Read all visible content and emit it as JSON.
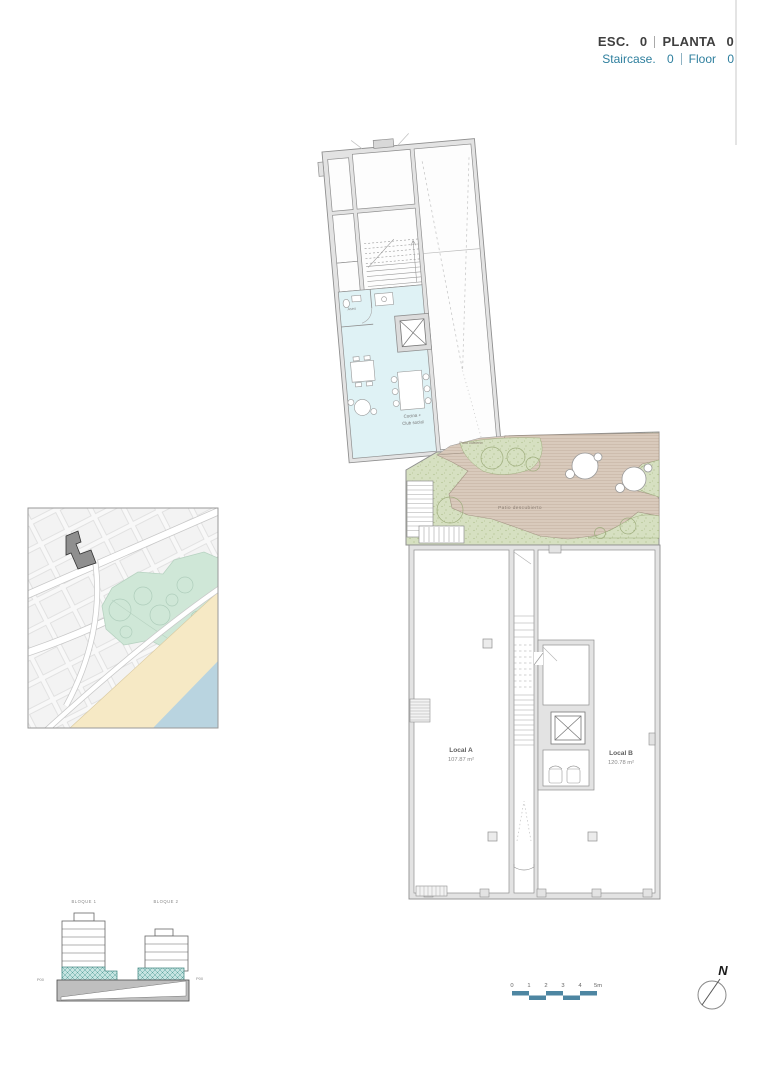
{
  "header": {
    "esc_label": "ESC.",
    "esc_value": "0",
    "planta_label": "PLANTA",
    "planta_value": "0",
    "staircase_label": "Staircase.",
    "staircase_value": "0",
    "floor_label": "Floor",
    "floor_value": "0"
  },
  "plan": {
    "labels": {
      "aseo": "Aseo",
      "cocina_line1": "Cocina +",
      "cocina_line2": "Club social",
      "patio_cubierto": "Patio cubierto",
      "patio_descubierto": "Patio descubierto",
      "local_a_name": "Local A",
      "local_a_area": "107.87 m²",
      "local_b_name": "Local B",
      "local_b_area": "120.78 m²"
    }
  },
  "elevation": {
    "bloque1": "BLOQUE 1",
    "bloque2": "BLOQUE 2",
    "p00_left": "P00",
    "p00_right": "P00"
  },
  "scale_bar": {
    "ticks": [
      "0",
      "1",
      "2",
      "3",
      "4",
      "5m"
    ]
  },
  "compass": {
    "north_label": "N"
  },
  "colors": {
    "accent_teal": "#2e7f9e",
    "scalebar_teal": "#4e86a2",
    "room_cyan": "#dff2f5",
    "deck_tan": "#d9cabc",
    "garden_green": "#d6e0c1",
    "map_green": "#cfe7d7",
    "map_sand": "#f6e9c5",
    "map_sea": "#b9d4e0",
    "elevation_teal": "#c6e4e1",
    "wall_gray": "#8f8f8f"
  }
}
